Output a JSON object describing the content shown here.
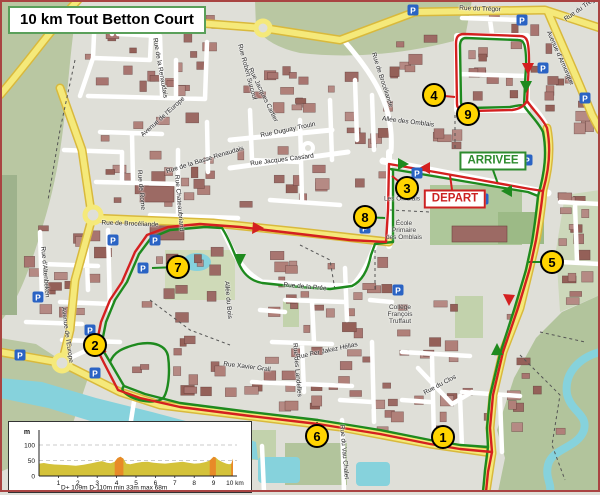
{
  "title": "10 km Tout Betton Court",
  "route_labels": {
    "arrivee": {
      "text": "ARRIVEE",
      "x": 493,
      "y": 161
    },
    "depart": {
      "text": "DEPART",
      "x": 455,
      "y": 199
    }
  },
  "colors": {
    "route_primary": "#d42020",
    "route_secondary": "#1e8a1e",
    "waypoint_fill": "#ffd400",
    "main_road": "#f5e97a",
    "water": "#86d2dc",
    "chart_area": "#d4c23a",
    "chart_steep": "#e88a28"
  },
  "waypoints": [
    {
      "label": "1",
      "x": 443,
      "y": 437
    },
    {
      "label": "2",
      "x": 95,
      "y": 345
    },
    {
      "label": "3",
      "x": 407,
      "y": 188
    },
    {
      "label": "4",
      "x": 434,
      "y": 95
    },
    {
      "label": "5",
      "x": 552,
      "y": 262
    },
    {
      "label": "6",
      "x": 317,
      "y": 436
    },
    {
      "label": "7",
      "x": 178,
      "y": 267
    },
    {
      "label": "8",
      "x": 365,
      "y": 217
    },
    {
      "label": "9",
      "x": 468,
      "y": 114
    }
  ],
  "parking_glyph": "P",
  "parkings": [
    {
      "x": 413,
      "y": 10
    },
    {
      "x": 522,
      "y": 20
    },
    {
      "x": 543,
      "y": 68
    },
    {
      "x": 585,
      "y": 98
    },
    {
      "x": 417,
      "y": 173
    },
    {
      "x": 483,
      "y": 199
    },
    {
      "x": 527,
      "y": 160
    },
    {
      "x": 113,
      "y": 240
    },
    {
      "x": 155,
      "y": 240
    },
    {
      "x": 143,
      "y": 268
    },
    {
      "x": 38,
      "y": 297
    },
    {
      "x": 90,
      "y": 330
    },
    {
      "x": 20,
      "y": 355
    },
    {
      "x": 95,
      "y": 373
    },
    {
      "x": 398,
      "y": 290
    },
    {
      "x": 365,
      "y": 228
    }
  ],
  "street_labels": [
    {
      "text": "Rue du Trégor",
      "x": 480,
      "y": 9,
      "rot": 2
    },
    {
      "text": "Rue du Trégor",
      "x": 582,
      "y": 8,
      "rot": -35
    },
    {
      "text": "Avenue d'Armorique",
      "x": 560,
      "y": 58,
      "rot": 66
    },
    {
      "text": "Allée des Omblais",
      "x": 408,
      "y": 122,
      "rot": 7
    },
    {
      "text": "Rue Duguay Trouin",
      "x": 288,
      "y": 130,
      "rot": -12
    },
    {
      "text": "Rue Jacques Cassard",
      "x": 282,
      "y": 160,
      "rot": -7
    },
    {
      "text": "Rue de Brocéliande",
      "x": 382,
      "y": 80,
      "rot": 72
    },
    {
      "text": "Rue de la Basse Renaudais",
      "x": 205,
      "y": 160,
      "rot": -17
    },
    {
      "text": "Avenue de l'Europe",
      "x": 163,
      "y": 117,
      "rot": -42
    },
    {
      "text": "Rue de Rome",
      "x": 141,
      "y": 190,
      "rot": 85
    },
    {
      "text": "Rue Chateaubriand",
      "x": 179,
      "y": 203,
      "rot": 85
    },
    {
      "text": "Rue Robert Surcouf",
      "x": 247,
      "y": 72,
      "rot": 75
    },
    {
      "text": "Rue Jacques Cartier",
      "x": 263,
      "y": 95,
      "rot": 64
    },
    {
      "text": "Rue de la Renaudais",
      "x": 160,
      "y": 68,
      "rot": 80
    },
    {
      "text": "Rue de Brocéliande",
      "x": 130,
      "y": 224,
      "rot": 2
    },
    {
      "text": "Rue d'Altenbeken",
      "x": 45,
      "y": 272,
      "rot": 85
    },
    {
      "text": "Avenue de l'Europe",
      "x": 67,
      "y": 335,
      "rot": 82
    },
    {
      "text": "Allée du Bois",
      "x": 228,
      "y": 300,
      "rot": 85
    },
    {
      "text": "Rue de la Prée",
      "x": 305,
      "y": 287,
      "rot": 5
    },
    {
      "text": "Rue Xavier Grall",
      "x": 247,
      "y": 367,
      "rot": 7
    },
    {
      "text": "Rue des Landelles",
      "x": 297,
      "y": 370,
      "rot": 85
    },
    {
      "text": "Rue Per Jakez Hélias",
      "x": 327,
      "y": 351,
      "rot": -12
    },
    {
      "text": "Rue du Clos",
      "x": 440,
      "y": 385,
      "rot": -28
    },
    {
      "text": "Rue du Vau Chalet",
      "x": 344,
      "y": 452,
      "rot": 85
    }
  ],
  "poi_labels": [
    {
      "text": "Collège\nFrançois\nTruffaut",
      "x": 400,
      "y": 315
    },
    {
      "text": "Les Omblais",
      "x": 402,
      "y": 200
    },
    {
      "text": "École\nPrimaire\ndes Omblais",
      "x": 404,
      "y": 231
    }
  ],
  "chart_data": {
    "type": "area",
    "title": "",
    "xlabel": "km",
    "ylabel": "m",
    "xlim": [
      0,
      10
    ],
    "ylim": [
      0,
      130
    ],
    "x_ticks": [
      "1",
      "2",
      "3",
      "4",
      "5",
      "6",
      "7",
      "8",
      "9"
    ],
    "x_end_label": "10 km",
    "y_ticks": [
      "0",
      "50",
      "100"
    ],
    "y_unit_label": "m",
    "grid": "dashed at 50 and 100",
    "profile_km_m": [
      [
        0,
        40
      ],
      [
        0.25,
        42
      ],
      [
        0.5,
        39
      ],
      [
        0.8,
        37
      ],
      [
        1.1,
        36
      ],
      [
        1.5,
        35
      ],
      [
        1.9,
        33
      ],
      [
        2.3,
        36
      ],
      [
        2.7,
        41
      ],
      [
        3.0,
        45
      ],
      [
        3.25,
        48
      ],
      [
        3.5,
        43
      ],
      [
        3.7,
        41
      ],
      [
        3.9,
        46
      ],
      [
        4.05,
        58
      ],
      [
        4.2,
        62
      ],
      [
        4.35,
        56
      ],
      [
        4.5,
        40
      ],
      [
        4.7,
        38
      ],
      [
        5.0,
        42
      ],
      [
        5.3,
        45
      ],
      [
        5.6,
        46
      ],
      [
        5.9,
        43
      ],
      [
        6.2,
        41
      ],
      [
        6.5,
        40
      ],
      [
        6.8,
        42
      ],
      [
        7.1,
        44
      ],
      [
        7.4,
        46
      ],
      [
        7.7,
        43
      ],
      [
        8.0,
        40
      ],
      [
        8.3,
        41
      ],
      [
        8.6,
        45
      ],
      [
        8.8,
        50
      ],
      [
        9.0,
        62
      ],
      [
        9.1,
        60
      ],
      [
        9.25,
        52
      ],
      [
        9.45,
        45
      ],
      [
        9.65,
        40
      ],
      [
        9.8,
        38
      ],
      [
        9.92,
        40
      ],
      [
        10,
        56
      ]
    ],
    "steep_segments_km": [
      [
        3.9,
        4.35
      ],
      [
        8.8,
        9.12
      ],
      [
        9.9,
        10
      ]
    ],
    "stats": "D+ 109m   D-110m   min 33m   max 68m"
  }
}
